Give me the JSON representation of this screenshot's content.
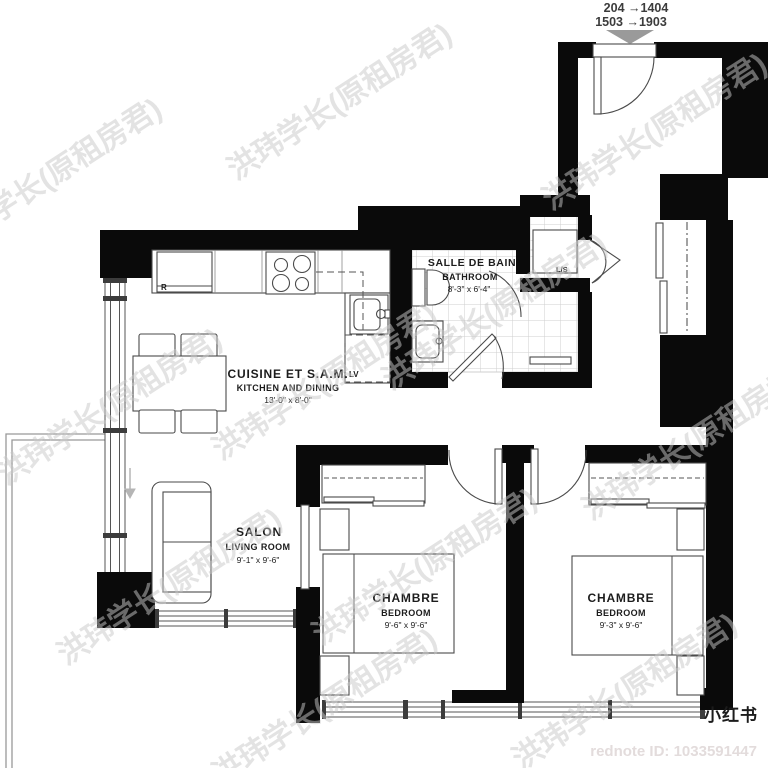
{
  "header": {
    "line1": "204 →1404",
    "line2": "1503 →1903"
  },
  "rooms": {
    "bathroom": {
      "name_fr": "SALLE DE BAIN",
      "name_en": "BATHROOM",
      "dims": "8'-3\" x 6'-4\""
    },
    "kitchen": {
      "name_fr": "CUISINE ET S.A.M.",
      "name_en": "KITCHEN AND DINING",
      "dims": "13'-0\" x 8'-0\""
    },
    "living": {
      "name_fr": "SALON",
      "name_en": "LIVING ROOM",
      "dims": "9'-1\" x 9'-6\""
    },
    "bedroom1": {
      "name_fr": "CHAMBRE",
      "name_en": "BEDROOM",
      "dims": "9'-6\" x 9'-6\""
    },
    "bedroom2": {
      "name_fr": "CHAMBRE",
      "name_en": "BEDROOM",
      "dims": "9'-3\" x 9'-6\""
    }
  },
  "appliances": {
    "fridge": "R",
    "dishwasher": "LV",
    "laundry": "L/S"
  },
  "watermark": {
    "text": "洪玮学长(原租房君)"
  },
  "footer": {
    "logo": "小红书",
    "rednote_id": "rednote ID: 1033591447"
  },
  "colors": {
    "wall": "#0a0a0a",
    "logo_red": "#e0302c",
    "arrow_gray": "#9a9a9a"
  }
}
